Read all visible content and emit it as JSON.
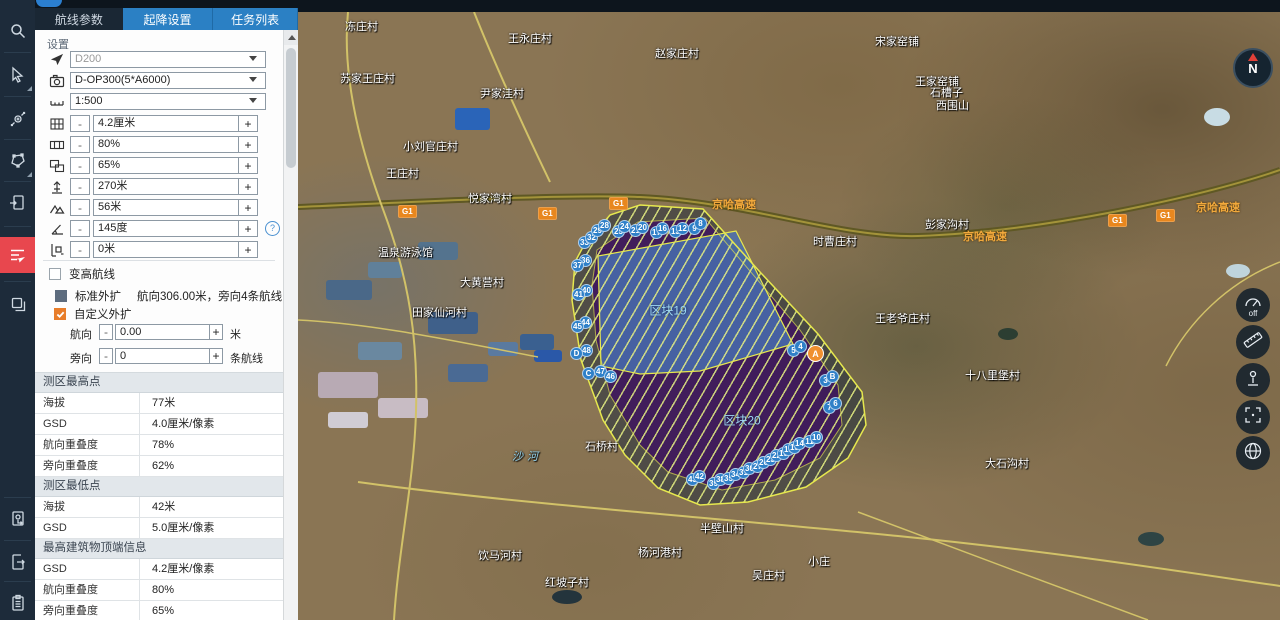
{
  "app": {
    "tabs": [
      {
        "label": "航线参数",
        "active": true
      },
      {
        "label": "起降设置",
        "active": false
      },
      {
        "label": "任务列表",
        "active": false
      }
    ]
  },
  "ui": {
    "minus": "-",
    "plus": "+",
    "help": "?"
  },
  "toolbar": {
    "items": [
      "search",
      "select-cursor",
      "move-point",
      "draw-polygon",
      "import-file",
      "route-plan",
      "layers",
      "doc-location",
      "doc-export",
      "task-report"
    ],
    "active_item": "route-plan"
  },
  "panel": {
    "settings_label": "设置",
    "dropdowns": [
      {
        "name": "aircraft",
        "value": "D200",
        "disabled": true
      },
      {
        "name": "camera",
        "value": "D-OP300(5*A6000)",
        "disabled": false
      },
      {
        "name": "scale",
        "value": "1:500",
        "disabled": false
      }
    ],
    "steppers": [
      {
        "name": "gsd",
        "value": "4.2厘米"
      },
      {
        "name": "forward-overlap",
        "value": "80%"
      },
      {
        "name": "side-overlap",
        "value": "65%"
      },
      {
        "name": "altitude",
        "value": "270米"
      },
      {
        "name": "relative-height",
        "value": "56米"
      },
      {
        "name": "course-angle",
        "value": "145度"
      },
      {
        "name": "margin",
        "value": "0米"
      }
    ],
    "variable_height_label": "变高航线",
    "standard_expand_label": "标准外扩",
    "standard_expand_info": "航向306.00米，旁向4条航线",
    "custom_expand_label": "自定义外扩",
    "course_row": {
      "label": "航向",
      "value": "0.00",
      "unit": "米"
    },
    "side_row": {
      "label": "旁向",
      "value": "0",
      "unit": "条航线"
    },
    "sections": [
      {
        "title": "测区最高点",
        "rows": [
          [
            "海拔",
            "77米"
          ],
          [
            "GSD",
            "4.0厘米/像素"
          ],
          [
            "航向重叠度",
            "78%"
          ],
          [
            "旁向重叠度",
            "62%"
          ]
        ]
      },
      {
        "title": "测区最低点",
        "rows": [
          [
            "海拔",
            "42米"
          ],
          [
            "GSD",
            "5.0厘米/像素"
          ]
        ]
      },
      {
        "title": "最高建筑物顶端信息",
        "rows": [
          [
            "GSD",
            "4.2厘米/像素"
          ],
          [
            "航向重叠度",
            "80%"
          ],
          [
            "旁向重叠度",
            "65%"
          ]
        ]
      }
    ]
  },
  "map": {
    "compass_label": "N",
    "controls": [
      {
        "name": "compass-mode",
        "label": "off"
      },
      {
        "name": "measure-distance",
        "label": ""
      },
      {
        "name": "street-view",
        "label": ""
      },
      {
        "name": "select-extent",
        "label": ""
      },
      {
        "name": "base-layers",
        "label": ""
      }
    ],
    "blocks": [
      {
        "label": "区块19",
        "x": 370,
        "y": 298
      },
      {
        "label": "区块20",
        "x": 444,
        "y": 408
      }
    ],
    "colors": {
      "survey_outline": "#e6e84e",
      "block_fill": "#3e1062",
      "selected_block_fill": "#4870b2",
      "waypoint": "#2f80c8",
      "home_point": "#f09030",
      "highway_label": "#f2a93c"
    },
    "labels": [
      {
        "text": "冻庄村",
        "x": 47,
        "y": 6,
        "type": "village"
      },
      {
        "text": "赵家庄村",
        "x": 357,
        "y": 33,
        "type": "village"
      },
      {
        "text": "王永庄村",
        "x": 210,
        "y": 18,
        "type": "village"
      },
      {
        "text": "苏家王庄村",
        "x": 42,
        "y": 58,
        "type": "village"
      },
      {
        "text": "尹家洼村",
        "x": 182,
        "y": 73,
        "type": "village"
      },
      {
        "text": "小刘官庄村",
        "x": 105,
        "y": 126,
        "type": "village"
      },
      {
        "text": "王庄村",
        "x": 88,
        "y": 153,
        "type": "village"
      },
      {
        "text": "悦家湾村",
        "x": 170,
        "y": 178,
        "type": "village"
      },
      {
        "text": "宋家窑铺",
        "x": 577,
        "y": 21,
        "type": "village"
      },
      {
        "text": "王家窑铺",
        "x": 617,
        "y": 61,
        "type": "village"
      },
      {
        "text": "石槽子",
        "x": 632,
        "y": 72,
        "type": "village"
      },
      {
        "text": "西围山",
        "x": 638,
        "y": 85,
        "type": "village"
      },
      {
        "text": "时曹庄村",
        "x": 515,
        "y": 221,
        "type": "village"
      },
      {
        "text": "彭家沟村",
        "x": 627,
        "y": 204,
        "type": "village"
      },
      {
        "text": "王老爷庄村",
        "x": 577,
        "y": 298,
        "type": "village"
      },
      {
        "text": "十八里堡村",
        "x": 667,
        "y": 355,
        "type": "village"
      },
      {
        "text": "大黄营村",
        "x": 162,
        "y": 262,
        "type": "village"
      },
      {
        "text": "田家仙河村",
        "x": 114,
        "y": 292,
        "type": "village"
      },
      {
        "text": "温泉游泳馆",
        "x": 80,
        "y": 232,
        "type": "village"
      },
      {
        "text": "石桥村",
        "x": 287,
        "y": 426,
        "type": "village"
      },
      {
        "text": "半壁山村",
        "x": 402,
        "y": 508,
        "type": "village"
      },
      {
        "text": "杨河港村",
        "x": 340,
        "y": 532,
        "type": "village"
      },
      {
        "text": "饮马河村",
        "x": 180,
        "y": 535,
        "type": "village"
      },
      {
        "text": "红坡子村",
        "x": 247,
        "y": 562,
        "type": "village"
      },
      {
        "text": "吴庄村",
        "x": 454,
        "y": 555,
        "type": "village"
      },
      {
        "text": "小庄",
        "x": 510,
        "y": 541,
        "type": "village"
      },
      {
        "text": "大石沟村",
        "x": 687,
        "y": 443,
        "type": "village"
      },
      {
        "text": "京哈高速",
        "x": 414,
        "y": 184,
        "type": "road"
      },
      {
        "text": "京哈高速",
        "x": 665,
        "y": 216,
        "type": "road"
      },
      {
        "text": "京哈高速",
        "x": 898,
        "y": 187,
        "type": "road"
      },
      {
        "text": "G1",
        "x": 100,
        "y": 193,
        "type": "badge"
      },
      {
        "text": "G1",
        "x": 240,
        "y": 195,
        "type": "badge"
      },
      {
        "text": "G1",
        "x": 311,
        "y": 185,
        "type": "badge"
      },
      {
        "text": "G1",
        "x": 810,
        "y": 202,
        "type": "badge"
      },
      {
        "text": "G1",
        "x": 858,
        "y": 197,
        "type": "badge"
      },
      {
        "text": "沙河",
        "x": 214,
        "y": 436,
        "type": "water"
      }
    ],
    "waypoints": [
      {
        "n": "33",
        "x": 287,
        "y": 231
      },
      {
        "n": "32",
        "x": 294,
        "y": 226
      },
      {
        "n": "29",
        "x": 300,
        "y": 219
      },
      {
        "n": "28",
        "x": 307,
        "y": 214
      },
      {
        "n": "25",
        "x": 321,
        "y": 220
      },
      {
        "n": "24",
        "x": 327,
        "y": 215
      },
      {
        "n": "21",
        "x": 338,
        "y": 219
      },
      {
        "n": "20",
        "x": 345,
        "y": 216
      },
      {
        "n": "17",
        "x": 359,
        "y": 221
      },
      {
        "n": "16",
        "x": 365,
        "y": 217
      },
      {
        "n": "13",
        "x": 378,
        "y": 220
      },
      {
        "n": "12",
        "x": 385,
        "y": 217
      },
      {
        "n": "9",
        "x": 397,
        "y": 217
      },
      {
        "n": "8",
        "x": 403,
        "y": 212
      },
      {
        "n": "36",
        "x": 288,
        "y": 249
      },
      {
        "n": "37",
        "x": 280,
        "y": 254
      },
      {
        "n": "40",
        "x": 289,
        "y": 279
      },
      {
        "n": "41",
        "x": 281,
        "y": 283
      },
      {
        "n": "44",
        "x": 288,
        "y": 311
      },
      {
        "n": "45",
        "x": 280,
        "y": 315
      },
      {
        "n": "48",
        "x": 289,
        "y": 339
      },
      {
        "n": "D",
        "x": 279,
        "y": 342
      },
      {
        "n": "C",
        "x": 291,
        "y": 362
      },
      {
        "n": "47",
        "x": 303,
        "y": 360
      },
      {
        "n": "46",
        "x": 313,
        "y": 365
      },
      {
        "n": "43",
        "x": 395,
        "y": 468
      },
      {
        "n": "42",
        "x": 402,
        "y": 465
      },
      {
        "n": "39",
        "x": 416,
        "y": 472
      },
      {
        "n": "38",
        "x": 423,
        "y": 468
      },
      {
        "n": "35",
        "x": 431,
        "y": 467
      },
      {
        "n": "34",
        "x": 438,
        "y": 463
      },
      {
        "n": "31",
        "x": 446,
        "y": 461
      },
      {
        "n": "30",
        "x": 452,
        "y": 457
      },
      {
        "n": "27",
        "x": 460,
        "y": 455
      },
      {
        "n": "26",
        "x": 466,
        "y": 451
      },
      {
        "n": "23",
        "x": 473,
        "y": 448
      },
      {
        "n": "22",
        "x": 479,
        "y": 444
      },
      {
        "n": "19",
        "x": 486,
        "y": 442
      },
      {
        "n": "18",
        "x": 491,
        "y": 438
      },
      {
        "n": "15",
        "x": 497,
        "y": 436
      },
      {
        "n": "14",
        "x": 502,
        "y": 432
      },
      {
        "n": "11",
        "x": 512,
        "y": 430
      },
      {
        "n": "10",
        "x": 519,
        "y": 426
      },
      {
        "n": "7",
        "x": 532,
        "y": 396
      },
      {
        "n": "6",
        "x": 538,
        "y": 392
      },
      {
        "n": "3",
        "x": 528,
        "y": 369
      },
      {
        "n": "B",
        "x": 535,
        "y": 365
      },
      {
        "n": "5",
        "x": 496,
        "y": 339
      },
      {
        "n": "4",
        "x": 503,
        "y": 335
      },
      {
        "n": "A",
        "x": 518,
        "y": 342,
        "type": "home"
      }
    ]
  }
}
